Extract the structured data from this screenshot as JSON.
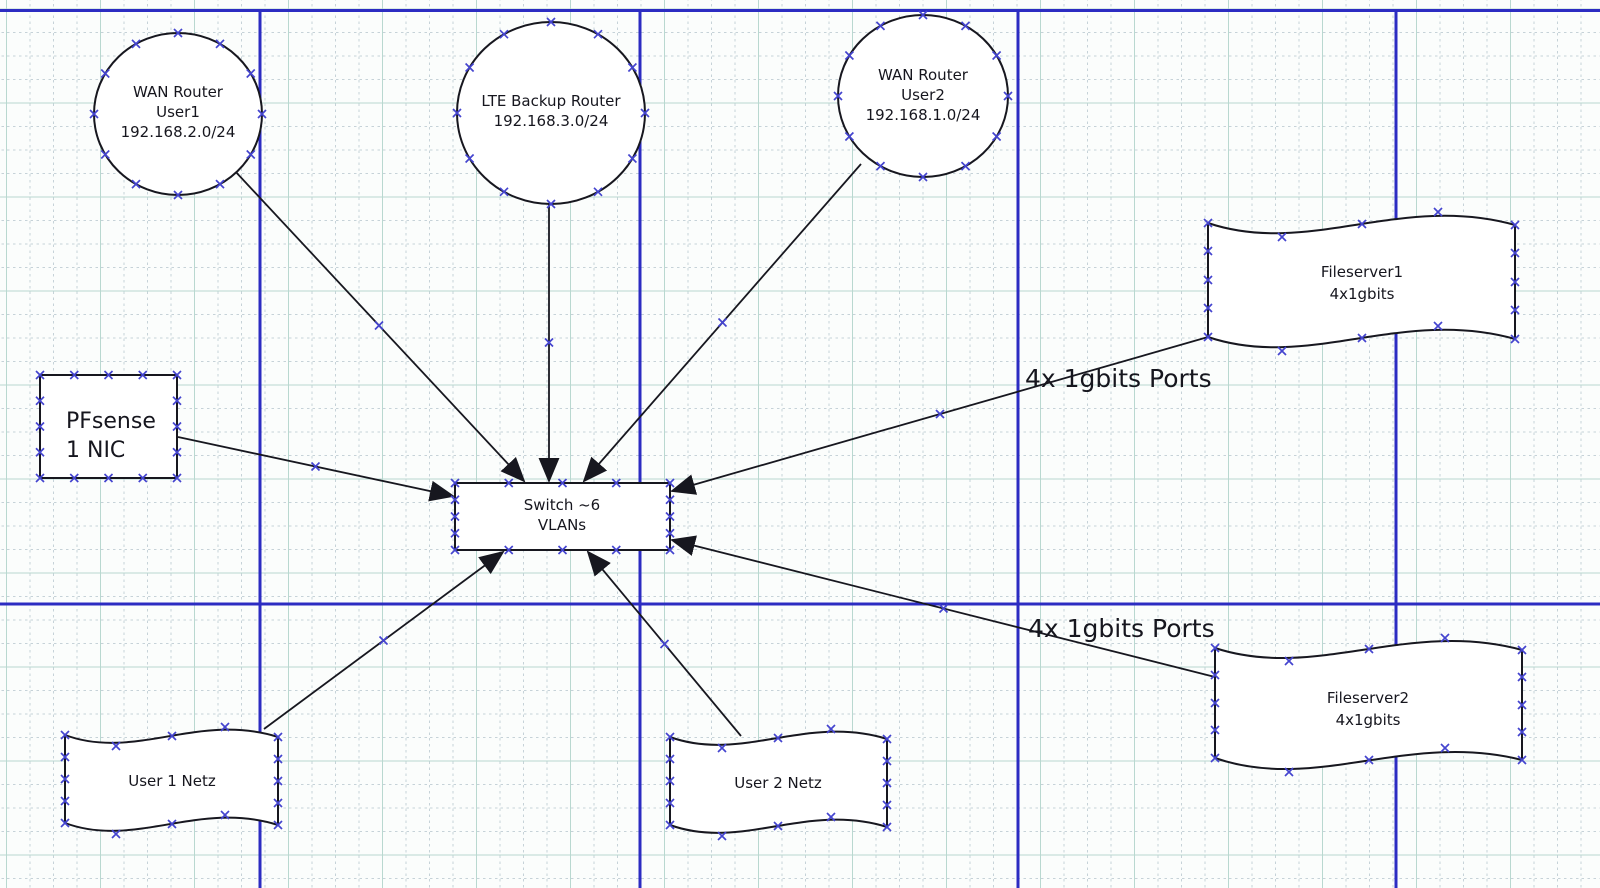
{
  "app": {
    "type": "diagram-editor-canvas",
    "description": "Network diagram on a gridded diagram-editor page"
  },
  "diagram": {
    "nodes": {
      "wan_router_user1": {
        "shape": "circle",
        "lines": [
          "WAN Router",
          "User1",
          "192.168.2.0/24"
        ]
      },
      "lte_backup_router": {
        "shape": "circle",
        "lines": [
          "LTE Backup Router",
          "192.168.3.0/24"
        ]
      },
      "wan_router_user2": {
        "shape": "circle",
        "lines": [
          "WAN Router",
          "User2",
          "192.168.1.0/24"
        ]
      },
      "pfsense": {
        "shape": "rectangle",
        "lines": [
          "PFsense",
          "1 NIC"
        ]
      },
      "switch": {
        "shape": "rectangle",
        "lines": [
          "Switch ~6",
          "VLANs"
        ]
      },
      "fileserver1": {
        "shape": "flag",
        "lines": [
          "Fileserver1",
          "4x1gbits"
        ]
      },
      "fileserver2": {
        "shape": "flag",
        "lines": [
          "Fileserver2",
          "4x1gbits"
        ]
      },
      "user1_netz": {
        "shape": "flag",
        "lines": [
          "User 1 Netz"
        ]
      },
      "user2_netz": {
        "shape": "flag",
        "lines": [
          "User 2 Netz"
        ]
      }
    },
    "labels": {
      "ports_label_1": "4x 1gbits Ports",
      "ports_label_2": "4x 1gbits Ports"
    },
    "edges": [
      {
        "from": "wan_router_user1",
        "to": "switch"
      },
      {
        "from": "lte_backup_router",
        "to": "switch"
      },
      {
        "from": "wan_router_user2",
        "to": "switch"
      },
      {
        "from": "pfsense",
        "to": "switch"
      },
      {
        "from": "fileserver1",
        "to": "switch"
      },
      {
        "from": "fileserver2",
        "to": "switch"
      },
      {
        "from": "user1_netz",
        "to": "switch"
      },
      {
        "from": "user2_netz",
        "to": "switch"
      }
    ],
    "colors": {
      "page_line": "#2c2cc2",
      "grid_minor": "#c6d2d8",
      "grid_major": "#b9d8d0",
      "connection_point": "#4444cf",
      "shape_stroke": "#17171f",
      "text": "#16161e",
      "background": "#fbfdfc"
    }
  }
}
